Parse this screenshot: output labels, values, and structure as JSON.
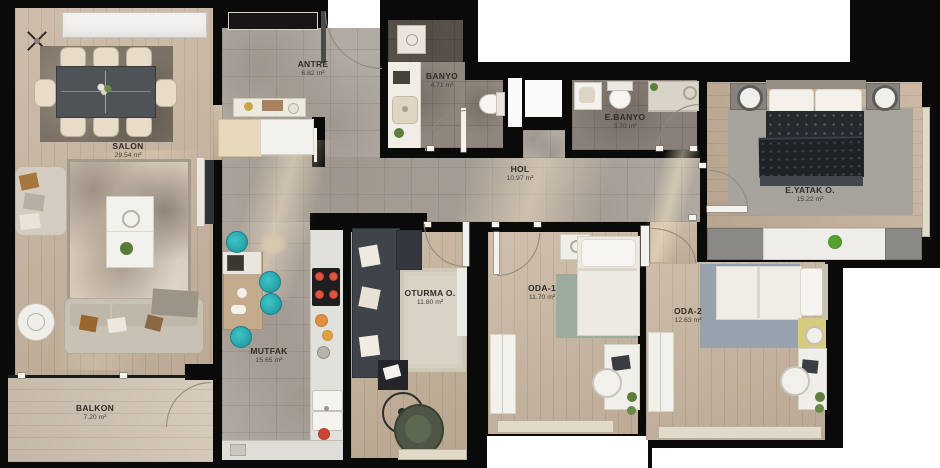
{
  "floorplan": {
    "type": "apartment-floor-plan",
    "rooms": [
      {
        "id": "salon",
        "name": "SALON",
        "area": "29.54 m²"
      },
      {
        "id": "antre",
        "name": "ANTRE",
        "area": "6.82 m²"
      },
      {
        "id": "banyo",
        "name": "BANYO",
        "area": "4.71 m²"
      },
      {
        "id": "e-banyo",
        "name": "E.BANYO",
        "area": "3.70 m²"
      },
      {
        "id": "hol",
        "name": "HOL",
        "area": "10.97 m²"
      },
      {
        "id": "e-yatak",
        "name": "E.YATAK O.",
        "area": "15.22 m²"
      },
      {
        "id": "oturma",
        "name": "OTURMA O.",
        "area": "11.80 m²"
      },
      {
        "id": "oda-1",
        "name": "ODA-1",
        "area": "11.70 m²"
      },
      {
        "id": "oda-2",
        "name": "ODA-2",
        "area": "12.63 m²"
      },
      {
        "id": "mutfak",
        "name": "MUTFAK",
        "area": "15.65 m²"
      },
      {
        "id": "balkon",
        "name": "BALKON",
        "area": "7.20 m²"
      }
    ],
    "colors": {
      "wall": "#0a0a0a",
      "exterior": "#ffffff",
      "wood_floor": "#c9b6a0",
      "tile_floor": "#b2aba3",
      "bath_tile": "#8f867d",
      "stool_teal": "#2cb4b6",
      "burner_red": "#c0392b",
      "label_text": "#2e2c29"
    }
  }
}
